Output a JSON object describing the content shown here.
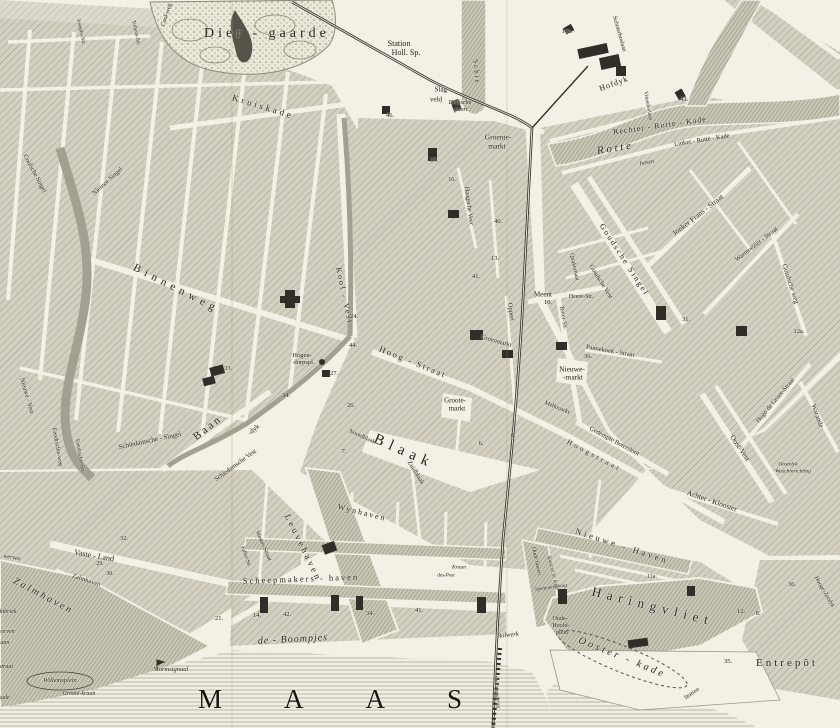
{
  "map": {
    "sea_label": "MAAS",
    "park_label": "Dier - gaarde",
    "entrepot_label": "Entrepôt",
    "colors": {
      "paper": "#f3f0e5",
      "ink": "#26241f",
      "block_fill": "#d3d0c2",
      "block_hatch": "#a5a294",
      "water_hatch": "#8a8778",
      "dark_building": "#2f2e28"
    },
    "labels": [
      {
        "t": "Station",
        "x": 399,
        "y": 44,
        "s": 8
      },
      {
        "t": "Holl. Sp.",
        "x": 406,
        "y": 53,
        "s": 8
      },
      {
        "t": "Slag-",
        "x": 442,
        "y": 90,
        "s": 7
      },
      {
        "t": "veld",
        "x": 436,
        "y": 100,
        "s": 7
      },
      {
        "t": "Delftsche",
        "x": 460,
        "y": 103,
        "s": 6,
        "i": 1
      },
      {
        "t": "poort",
        "x": 461,
        "y": 110,
        "s": 6,
        "i": 1
      },
      {
        "t": "Groente-",
        "x": 498,
        "y": 137,
        "s": 7.5
      },
      {
        "t": "markt",
        "x": 497,
        "y": 146,
        "s": 7.5
      },
      {
        "t": "Kruiskade",
        "x": 263,
        "y": 107,
        "r": 17,
        "s": 9,
        "ls": 3
      },
      {
        "t": "Cool-weg",
        "x": 167,
        "y": 15,
        "r": -72,
        "s": 6
      },
      {
        "t": "Josephs-Str.",
        "x": 80,
        "y": 32,
        "r": 78,
        "s": 5.5
      },
      {
        "t": "Tollens-Str.",
        "x": 135,
        "y": 33,
        "r": 78,
        "s": 5.5
      },
      {
        "t": "Schie",
        "x": 476,
        "y": 72,
        "r": 85,
        "s": 7,
        "ls": 2
      },
      {
        "t": "Schoterboslaan",
        "x": 619,
        "y": 34,
        "r": 74,
        "s": 6
      },
      {
        "t": "Hofdyk",
        "x": 614,
        "y": 84,
        "r": -20,
        "s": 8,
        "ls": 1
      },
      {
        "t": "Vriendenlaan",
        "x": 647,
        "y": 106,
        "r": 80,
        "s": 5.5
      },
      {
        "t": "Rechter - Rotte - Kade",
        "x": 660,
        "y": 126,
        "r": -8,
        "s": 8,
        "ls": 1
      },
      {
        "t": "R o t t e",
        "x": 614,
        "y": 149,
        "r": -9,
        "s": 11,
        "i": 1
      },
      {
        "t": "Linker - Rotte - Kade",
        "x": 702,
        "y": 141,
        "r": -9,
        "s": 6.5
      },
      {
        "t": "haven",
        "x": 647,
        "y": 163,
        "r": -10,
        "s": 6,
        "i": 1
      },
      {
        "t": "Hogen-",
        "x": 302,
        "y": 356,
        "s": 6.5
      },
      {
        "t": "dorpspl.",
        "x": 304,
        "y": 363,
        "s": 6.5
      },
      {
        "t": "Binnenweg",
        "x": 176,
        "y": 289,
        "r": 27,
        "s": 11,
        "ls": 5
      },
      {
        "t": "Kool - Vest",
        "x": 344,
        "y": 296,
        "r": 78,
        "s": 8,
        "ls": 2
      },
      {
        "t": "Coolsche Singel",
        "x": 34,
        "y": 174,
        "r": 62,
        "s": 6.5
      },
      {
        "t": "Nieuwe Singel",
        "x": 108,
        "y": 182,
        "r": -42,
        "s": 6.5
      },
      {
        "t": "Nieuwe - Vest",
        "x": 26,
        "y": 396,
        "r": 74,
        "s": 6.5
      },
      {
        "t": "Eendrachts-weg",
        "x": 57,
        "y": 447,
        "r": 80,
        "s": 6
      },
      {
        "t": "Eendrachts-Str.",
        "x": 79,
        "y": 456,
        "r": 80,
        "s": 5.5
      },
      {
        "t": "Schiedamsche - Singel",
        "x": 150,
        "y": 441,
        "r": -12,
        "s": 7
      },
      {
        "t": "Schiedamsche Vest",
        "x": 236,
        "y": 466,
        "r": -36,
        "s": 6.5
      },
      {
        "t": "B a a n",
        "x": 207,
        "y": 429,
        "r": -38,
        "s": 11
      },
      {
        "t": "-dyk",
        "x": 254,
        "y": 430,
        "r": -42,
        "s": 7
      },
      {
        "t": "Haagsche Veer",
        "x": 468,
        "y": 206,
        "r": 83,
        "s": 6.5
      },
      {
        "t": "Goudsche Singel",
        "x": 624,
        "y": 260,
        "r": 57,
        "s": 8,
        "ls": 2
      },
      {
        "t": "Goudsche Vest",
        "x": 600,
        "y": 282,
        "r": 58,
        "s": 6.5
      },
      {
        "t": "Jonker Frans - Straat",
        "x": 698,
        "y": 215,
        "r": -38,
        "s": 7.5
      },
      {
        "t": "Warmoezier - Straat",
        "x": 757,
        "y": 245,
        "r": -38,
        "s": 6.5
      },
      {
        "t": "Goudsche weg",
        "x": 790,
        "y": 284,
        "r": 72,
        "s": 7
      },
      {
        "t": "Meent",
        "x": 543,
        "y": 295,
        "s": 7
      },
      {
        "t": "10.",
        "x": 548,
        "y": 303,
        "s": 6.5
      },
      {
        "t": "Heere-Str.",
        "x": 581,
        "y": 297,
        "s": 6
      },
      {
        "t": "Quakernaat",
        "x": 574,
        "y": 267,
        "r": 78,
        "s": 6
      },
      {
        "t": "Boter-Str.",
        "x": 563,
        "y": 318,
        "r": 80,
        "s": 6
      },
      {
        "t": "Oppert",
        "x": 510,
        "y": 312,
        "r": 82,
        "s": 6.5
      },
      {
        "t": "Groenmarkt",
        "x": 496,
        "y": 342,
        "r": 16,
        "s": 6.5
      },
      {
        "t": "Hoog - Straat",
        "x": 413,
        "y": 362,
        "r": 22,
        "s": 8.5,
        "ls": 2
      },
      {
        "t": "Hoogstraat",
        "x": 594,
        "y": 456,
        "r": 28,
        "s": 7,
        "ls": 3
      },
      {
        "t": "Groote-",
        "x": 455,
        "y": 401,
        "s": 7
      },
      {
        "t": "markt",
        "x": 457,
        "y": 409,
        "s": 7
      },
      {
        "t": "Nieuwe-",
        "x": 572,
        "y": 369,
        "s": 7.5
      },
      {
        "t": "-markt",
        "x": 573,
        "y": 377,
        "s": 7.5
      },
      {
        "t": "Melkmarkt",
        "x": 557,
        "y": 408,
        "r": 22,
        "s": 6
      },
      {
        "t": "Pannekoek - Straat",
        "x": 610,
        "y": 352,
        "r": 10,
        "s": 6.5
      },
      {
        "t": "Gedempte Botersloot",
        "x": 614,
        "y": 442,
        "r": 28,
        "s": 6.5
      },
      {
        "t": "Blaak",
        "x": 404,
        "y": 452,
        "r": 24,
        "s": 15,
        "ls": 6
      },
      {
        "t": "Zuidblaak",
        "x": 415,
        "y": 473,
        "r": 58,
        "s": 6.5
      },
      {
        "t": "Noordblaak",
        "x": 362,
        "y": 437,
        "r": 24,
        "s": 6
      },
      {
        "t": "Wynhaven",
        "x": 362,
        "y": 513,
        "r": 14,
        "s": 8,
        "ls": 2
      },
      {
        "t": "Leuvehaven",
        "x": 303,
        "y": 548,
        "r": 64,
        "s": 9,
        "ls": 3
      },
      {
        "t": "Wester-Straat",
        "x": 263,
        "y": 546,
        "r": 66,
        "s": 6
      },
      {
        "t": "Juffer-Str.",
        "x": 245,
        "y": 557,
        "r": 70,
        "s": 5.5
      },
      {
        "t": "Vaste - Land",
        "x": 94,
        "y": 556,
        "r": 10,
        "s": 8
      },
      {
        "t": "Zalmhaven",
        "x": 86,
        "y": 581,
        "r": 18,
        "s": 6.5
      },
      {
        "t": "Z a l m h a v e n",
        "x": 42,
        "y": 596,
        "r": 28,
        "s": 10,
        "i": 1
      },
      {
        "t": "werven",
        "x": 12,
        "y": 558,
        "r": 10,
        "s": 6,
        "i": 1
      },
      {
        "t": "fabriek",
        "x": 8,
        "y": 612,
        "s": 6,
        "i": 1
      },
      {
        "t": "werven",
        "x": 6,
        "y": 632,
        "s": 6,
        "i": 1
      },
      {
        "t": "laan",
        "x": 4,
        "y": 643,
        "s": 6,
        "i": 1
      },
      {
        "t": "straat",
        "x": 6,
        "y": 667,
        "s": 6,
        "i": 1
      },
      {
        "t": "kade",
        "x": 4,
        "y": 698,
        "s": 6,
        "i": 1
      },
      {
        "t": "Willemsplein",
        "x": 60,
        "y": 681,
        "s": 6.5,
        "i": 1
      },
      {
        "t": "Groote-kraan",
        "x": 79,
        "y": 694,
        "s": 6,
        "i": 1
      },
      {
        "t": "Stormsignaal",
        "x": 171,
        "y": 670,
        "s": 6.5,
        "i": 1
      },
      {
        "t": "Scheepmakers - haven",
        "x": 301,
        "y": 579,
        "r": -2,
        "s": 8.5,
        "ls": 2
      },
      {
        "t": "de - Boompjes",
        "x": 293,
        "y": 640,
        "r": -3,
        "s": 10,
        "ls": 1,
        "i": 1
      },
      {
        "t": "Spoorwegbrug",
        "x": 496,
        "y": 692,
        "r": 84,
        "s": 5.5,
        "i": 1
      },
      {
        "t": "Bolwerk",
        "x": 508,
        "y": 636,
        "r": -6,
        "s": 6.5,
        "i": 1
      },
      {
        "t": "Oude haven",
        "x": 536,
        "y": 561,
        "r": 78,
        "s": 6,
        "i": 1
      },
      {
        "t": "Spaansche kade",
        "x": 552,
        "y": 573,
        "r": 77,
        "s": 5.5,
        "i": 1
      },
      {
        "t": "Spanjaardsbrug",
        "x": 551,
        "y": 588,
        "r": -8,
        "s": 5,
        "i": 1
      },
      {
        "t": "Nieuwe - Haven",
        "x": 622,
        "y": 546,
        "r": 18,
        "s": 8.5,
        "ls": 3
      },
      {
        "t": "Haringvliet",
        "x": 653,
        "y": 606,
        "r": 14,
        "s": 13,
        "ls": 6
      },
      {
        "t": "Oude-",
        "x": 560,
        "y": 619,
        "s": 6
      },
      {
        "t": "Hoofd-",
        "x": 561,
        "y": 626,
        "s": 6
      },
      {
        "t": "plein",
        "x": 562,
        "y": 633,
        "s": 6
      },
      {
        "t": "Ooster - kade",
        "x": 622,
        "y": 658,
        "r": 22,
        "s": 10,
        "ls": 3,
        "i": 1
      },
      {
        "t": "Station",
        "x": 692,
        "y": 694,
        "r": -35,
        "s": 6,
        "i": 1
      },
      {
        "t": "Hooge-Zeedyk",
        "x": 824,
        "y": 592,
        "r": 60,
        "s": 6,
        "i": 1
      },
      {
        "t": "Hugo de Groot-Straat",
        "x": 776,
        "y": 401,
        "r": -50,
        "s": 6.5
      },
      {
        "t": "Warande",
        "x": 817,
        "y": 416,
        "r": 70,
        "s": 7
      },
      {
        "t": "Oost-Vest",
        "x": 740,
        "y": 448,
        "r": 56,
        "s": 7.5
      },
      {
        "t": "Achter - Klooster",
        "x": 712,
        "y": 501,
        "r": 19,
        "s": 7.5
      },
      {
        "t": "Oostelyk",
        "x": 788,
        "y": 465,
        "s": 5.5,
        "i": 1
      },
      {
        "t": "Waschinrichting",
        "x": 793,
        "y": 472,
        "s": 5.5,
        "i": 1
      },
      {
        "t": "Kraan",
        "x": 459,
        "y": 568,
        "s": 5.5,
        "i": 1
      },
      {
        "t": "des-Post",
        "x": 446,
        "y": 576,
        "s": 5,
        "i": 1
      },
      {
        "t": "14a.",
        "x": 567,
        "y": 32,
        "s": 6.5
      },
      {
        "t": "43.",
        "x": 684,
        "y": 100,
        "s": 6.5
      },
      {
        "t": "46.",
        "x": 390,
        "y": 116,
        "s": 6.5
      },
      {
        "t": "37.",
        "x": 434,
        "y": 161,
        "s": 6.5
      },
      {
        "t": "16.",
        "x": 452,
        "y": 180,
        "s": 6
      },
      {
        "t": "40.",
        "x": 498,
        "y": 222,
        "s": 6.5
      },
      {
        "t": "13.",
        "x": 495,
        "y": 259,
        "s": 6.5
      },
      {
        "t": "41.",
        "x": 476,
        "y": 277,
        "s": 6.5
      },
      {
        "t": "24.",
        "x": 354,
        "y": 317,
        "s": 6.5
      },
      {
        "t": "44.",
        "x": 353,
        "y": 346,
        "s": 6.5
      },
      {
        "t": "27.",
        "x": 334,
        "y": 374,
        "s": 6.5
      },
      {
        "t": "26.",
        "x": 351,
        "y": 406,
        "s": 6.5
      },
      {
        "t": "34.",
        "x": 286,
        "y": 396,
        "s": 6.5
      },
      {
        "t": "33.",
        "x": 228,
        "y": 369,
        "s": 6.5
      },
      {
        "t": "7.",
        "x": 344,
        "y": 452,
        "s": 6.5
      },
      {
        "t": "6.",
        "x": 481,
        "y": 444,
        "s": 6.5
      },
      {
        "t": "8.",
        "x": 513,
        "y": 436,
        "s": 6.5
      },
      {
        "t": "36.",
        "x": 588,
        "y": 357,
        "s": 6.5
      },
      {
        "t": "31.",
        "x": 686,
        "y": 320,
        "s": 6.5
      },
      {
        "t": "12a.",
        "x": 799,
        "y": 332,
        "s": 6.5
      },
      {
        "t": "29.",
        "x": 100,
        "y": 564,
        "s": 6
      },
      {
        "t": "30.",
        "x": 110,
        "y": 574,
        "s": 6
      },
      {
        "t": "32.",
        "x": 124,
        "y": 539,
        "s": 6
      },
      {
        "t": "21.",
        "x": 219,
        "y": 619,
        "s": 6.5
      },
      {
        "t": "14.",
        "x": 257,
        "y": 616,
        "s": 6.5
      },
      {
        "t": "42.",
        "x": 287,
        "y": 615,
        "s": 6.5
      },
      {
        "t": "34.",
        "x": 370,
        "y": 614,
        "s": 6.5
      },
      {
        "t": "41.",
        "x": 419,
        "y": 611,
        "s": 6.5
      },
      {
        "t": "11a.",
        "x": 652,
        "y": 577,
        "s": 6
      },
      {
        "t": "12.",
        "x": 741,
        "y": 612,
        "s": 6.5
      },
      {
        "t": "8.",
        "x": 758,
        "y": 614,
        "s": 6
      },
      {
        "t": "35.",
        "x": 728,
        "y": 662,
        "s": 6.5
      },
      {
        "t": "36.",
        "x": 792,
        "y": 585,
        "s": 6.5
      }
    ]
  }
}
